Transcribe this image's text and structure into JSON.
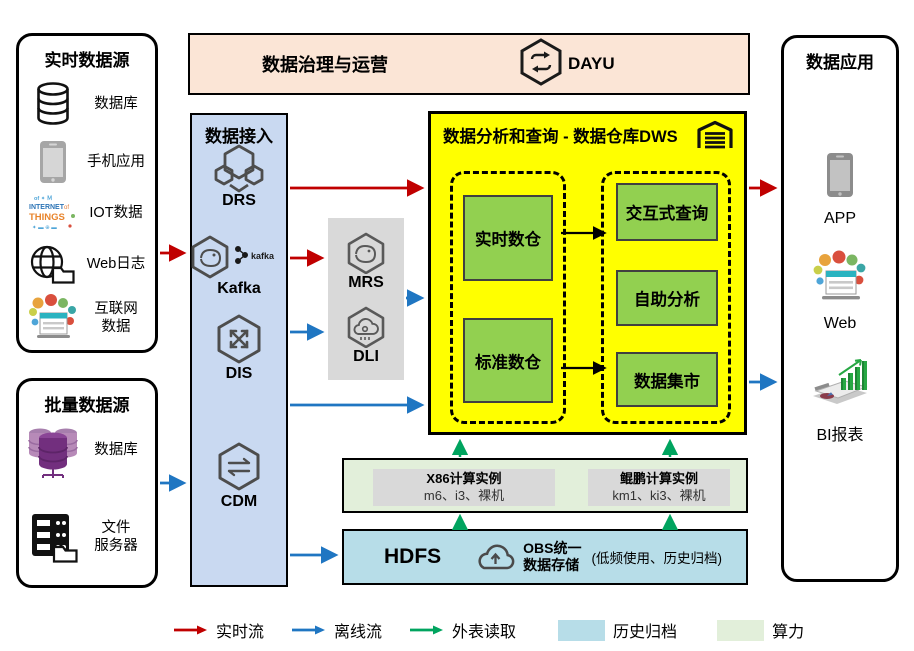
{
  "realtime": {
    "title": "实时数据源",
    "items": [
      {
        "icon": "database-icon",
        "label": "数据库"
      },
      {
        "icon": "mobile-phone-icon",
        "label": "手机应用"
      },
      {
        "icon": "iot-wordcloud-icon",
        "label": "IOT数据"
      },
      {
        "icon": "globe-folder-icon",
        "label": "Web日志"
      },
      {
        "icon": "internet-bubbles-icon",
        "label": "互联网\n数据"
      }
    ]
  },
  "batch": {
    "title": "批量数据源",
    "items": [
      {
        "icon": "purple-database-icon",
        "label": "数据库"
      },
      {
        "icon": "file-server-icon",
        "label": "文件\n服务器"
      }
    ]
  },
  "governance": {
    "title": "数据治理与运营",
    "product": "DAYU"
  },
  "access": {
    "title": "数据接入",
    "items": [
      "DRS",
      "Kafka",
      "DIS",
      "CDM"
    ],
    "kafka_tag": "kafka"
  },
  "processing": {
    "items": [
      "MRS",
      "DLI"
    ]
  },
  "dws": {
    "title": "数据分析和查询 - 数据仓库DWS",
    "left_boxes": [
      "实时数仓",
      "标准数仓"
    ],
    "right_boxes": [
      "交互式查询",
      "自助分析",
      "数据集市"
    ]
  },
  "compute": {
    "x86": {
      "name": "X86计算实例",
      "spec": "m6、i3、裸机"
    },
    "kunpeng": {
      "name": "鲲鹏计算实例",
      "spec": "km1、ki3、裸机"
    }
  },
  "storage": {
    "hdfs": "HDFS",
    "obs": "OBS统一\n数据存储",
    "note": "(低频使用、历史归档)"
  },
  "apps": {
    "title": "数据应用",
    "items": [
      "APP",
      "Web",
      "BI报表"
    ]
  },
  "legend": {
    "realtime": "实时流",
    "offline": "离线流",
    "external": "外表读取",
    "archive": "历史归档",
    "compute": "算力"
  },
  "colors": {
    "realtime_arrow": "#C00000",
    "offline_arrow": "#1F76C2",
    "external_arrow": "#00A45F",
    "archive_fill": "#B7DDE8",
    "compute_fill": "#E2EFDA",
    "dws_fill": "#FFFF00",
    "warehouse_box_fill": "#92D050",
    "access_fill": "#C9D9F1",
    "governance_fill": "#FBE5D6",
    "processing_fill": "#D9D9D9"
  }
}
